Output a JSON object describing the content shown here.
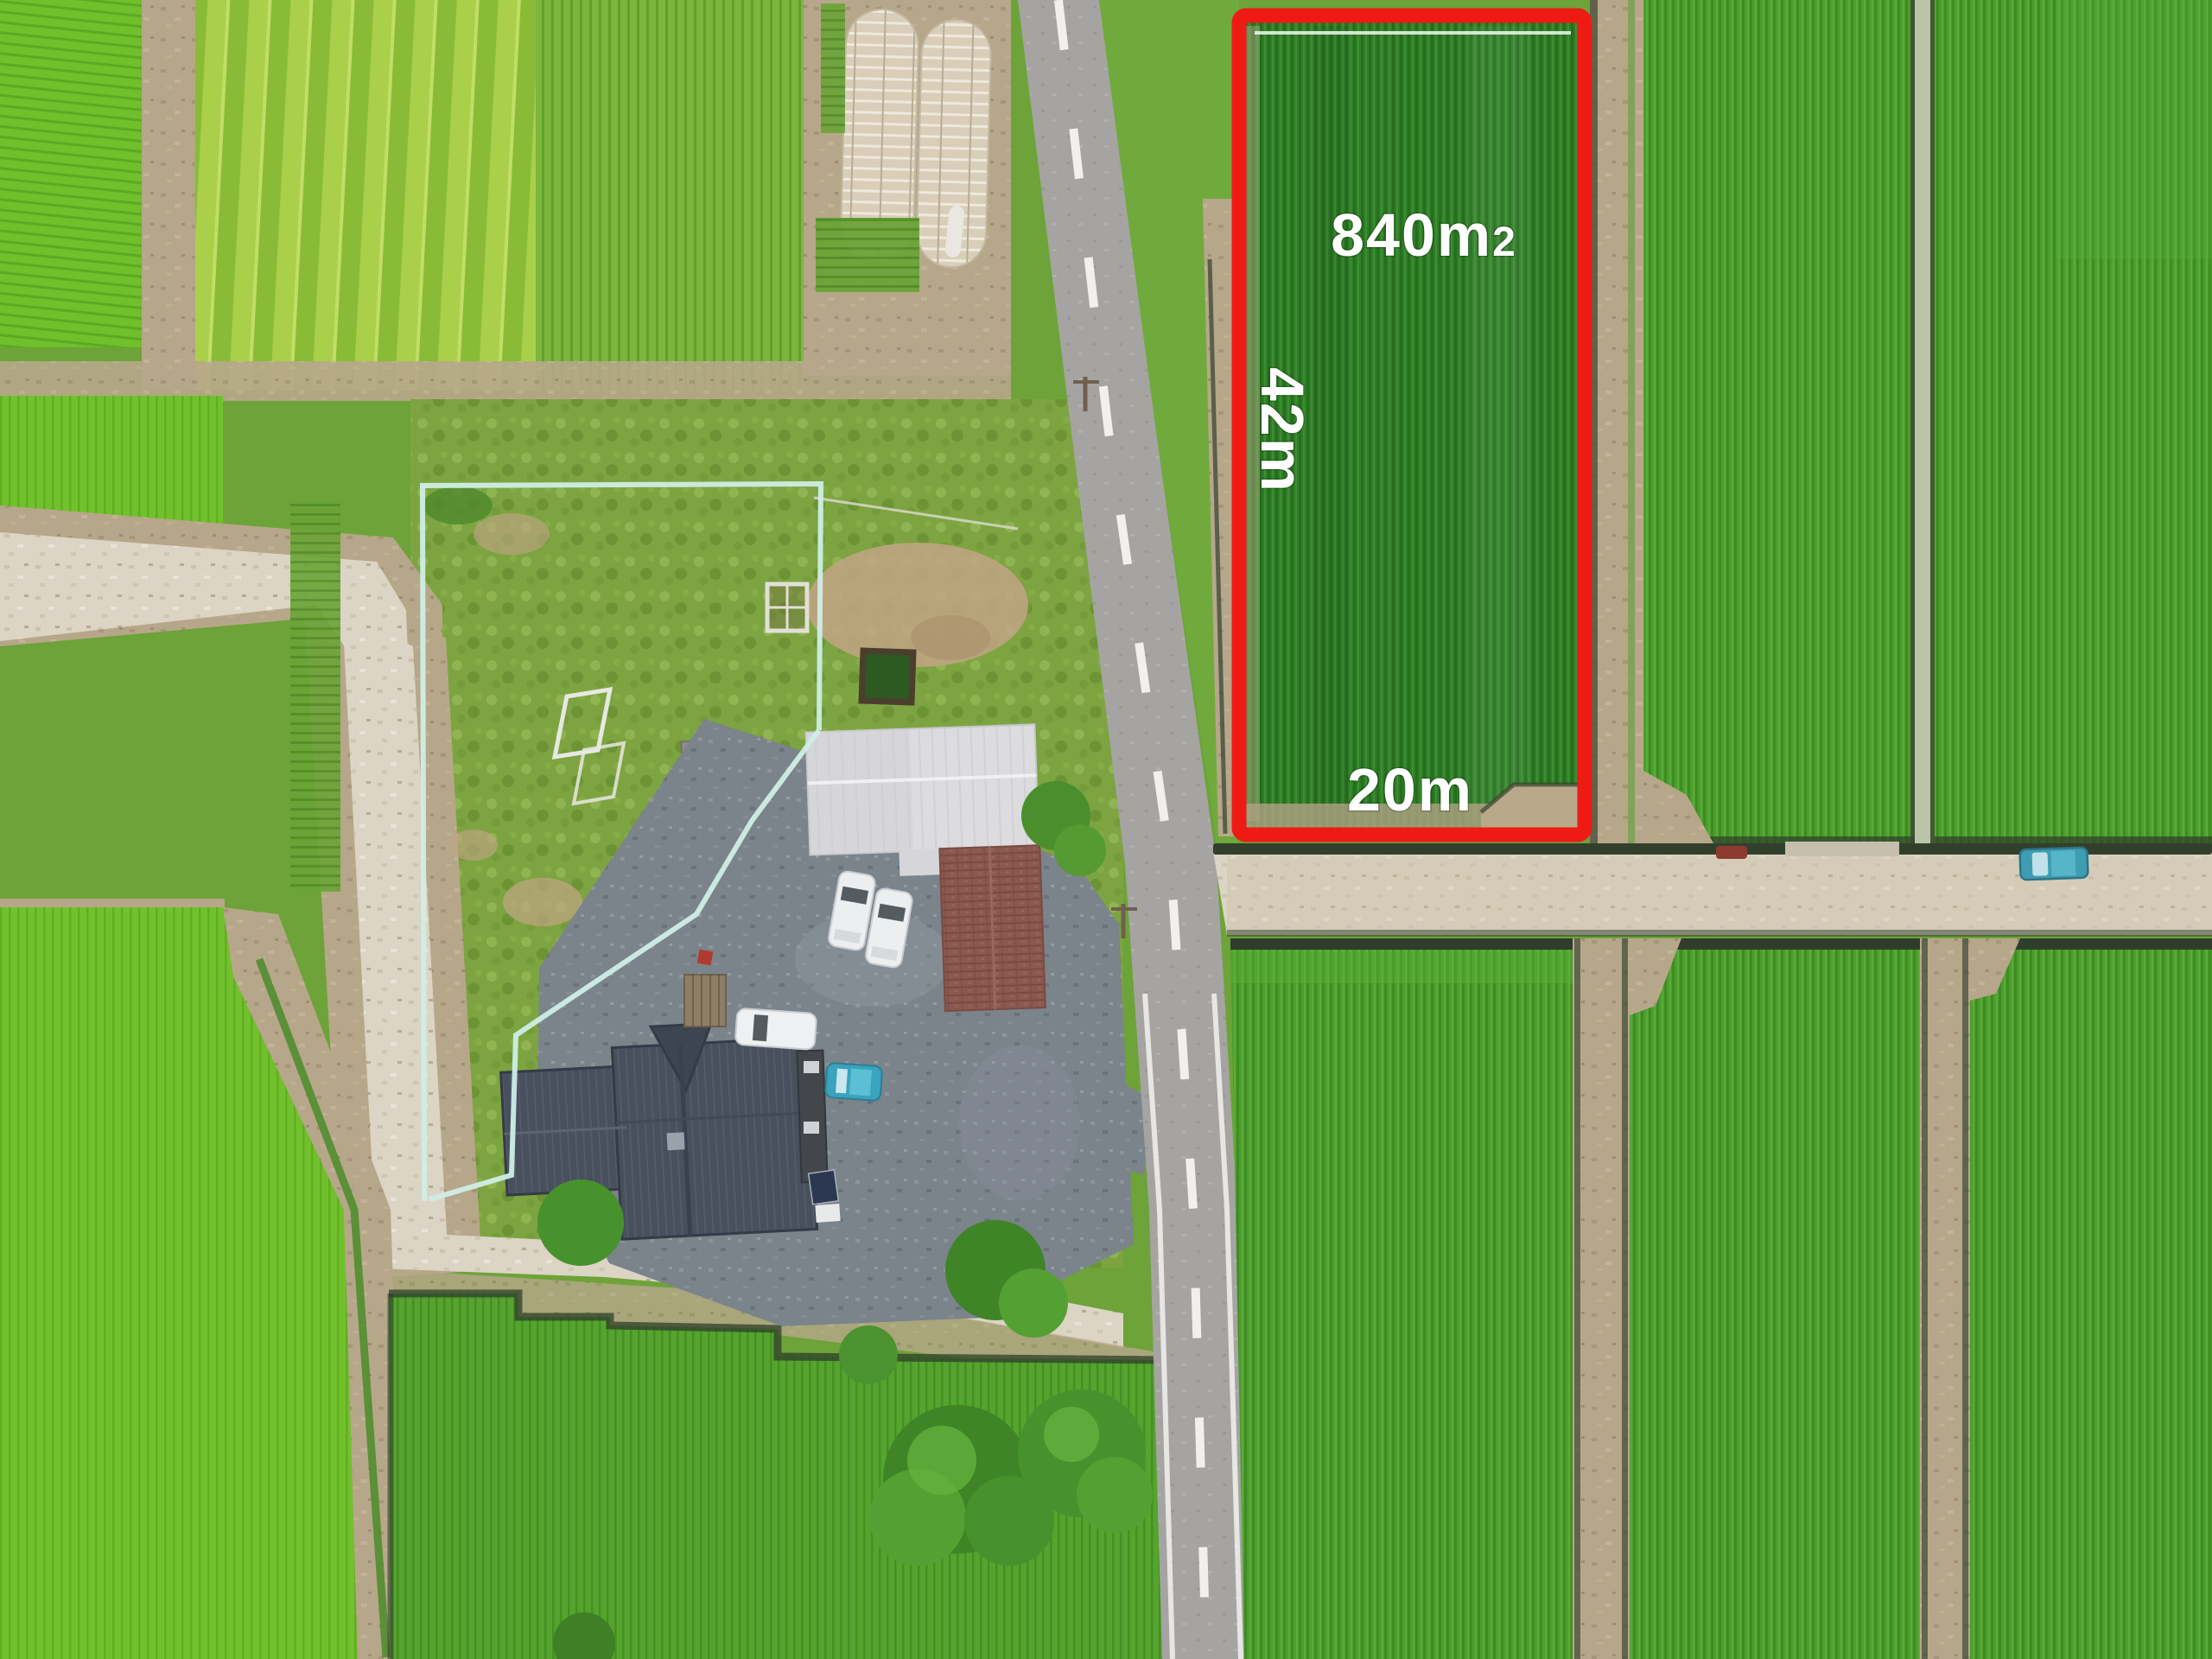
{
  "plot": {
    "area_main": "840m",
    "area_exponent": "2",
    "side_label": "42m",
    "front_label": "20m"
  },
  "colors": {
    "outline_red": "#ee1b15",
    "label_white": "#ffffff",
    "plot_green": "#2f7e27",
    "paddy_green": "#72c12c",
    "field_green": "#4c9e2e",
    "dirt_tan": "#b7a78a",
    "gravel_light": "#dcd4c4",
    "asphalt_gray": "#a5a4a2",
    "driveway_gray": "#7b838b",
    "house_roof": "#48505e",
    "barn_roof_white": "#dcdbde",
    "barn_roof_red": "#8c5950",
    "fence_teal": "#cfeee6",
    "tree_green": "#4e9430",
    "channel_dark": "#333f2d",
    "teal_car": "#3e9db2"
  }
}
